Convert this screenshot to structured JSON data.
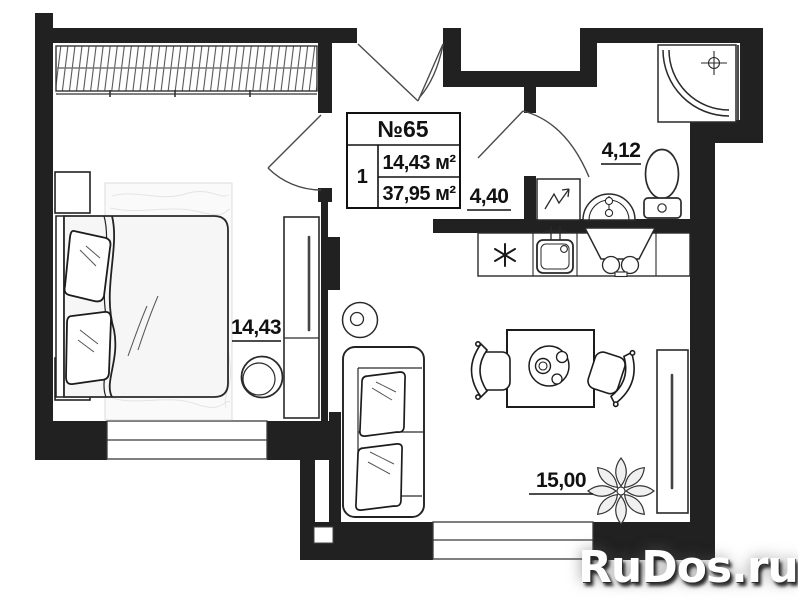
{
  "info_box": {
    "number": "№65",
    "rooms_count": "1",
    "living_area": "14,43 м²",
    "total_area": "37,95 м²"
  },
  "labels": {
    "bedroom_area": "14,43",
    "hallway_area": "4,40",
    "bathroom_area": "4,12",
    "living_area": "15,00"
  },
  "watermark": {
    "text": "RuDos.ru"
  },
  "colors": {
    "wall": "#212121",
    "line": "#333333",
    "rug": "#fafafa",
    "paper": "#ffffff"
  }
}
